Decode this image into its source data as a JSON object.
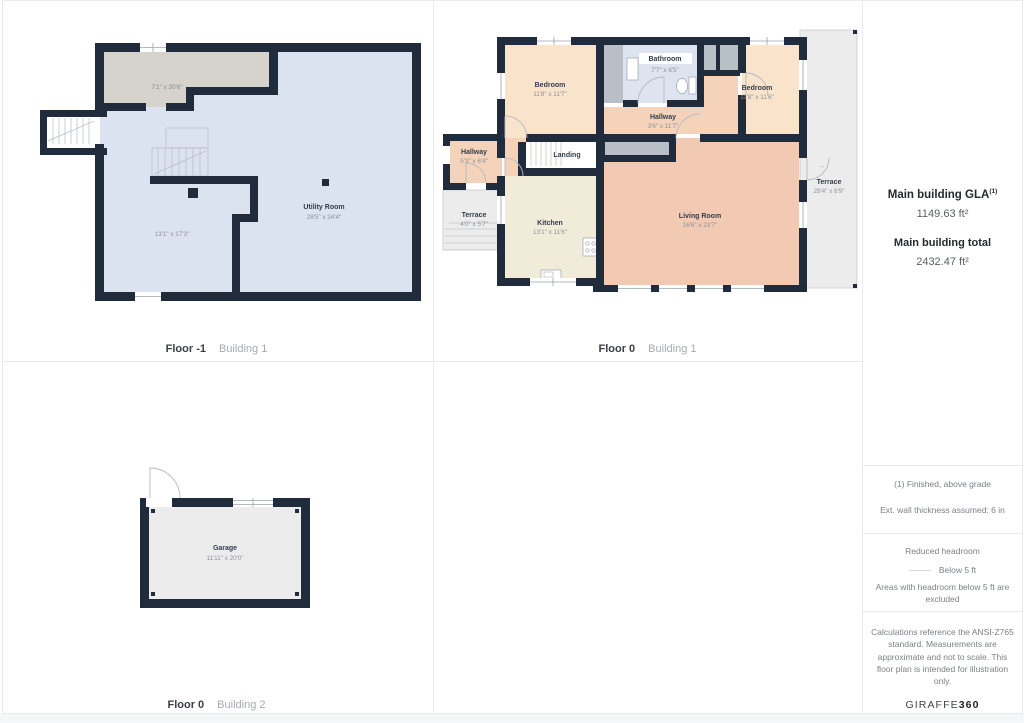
{
  "panels": {
    "b1fm1": {
      "floor": "Floor -1",
      "building": "Building 1",
      "reduced_dims": "7'1\" x 20'6\"",
      "room13_dims": "13'1\" x 17'3\"",
      "utility_name": "Utility Room",
      "utility_dims": "28'5\" x 34'4\""
    },
    "b1f0": {
      "floor": "Floor 0",
      "building": "Building 1",
      "bedroom_left": {
        "name": "Bedroom",
        "dims": "11'8\" x 11'7\""
      },
      "bathroom": {
        "name": "Bathroom",
        "dims": "7'7\" x 6'5\""
      },
      "bedroom_right": {
        "name": "Bedroom",
        "dims": "11'8\" x 11'6\""
      },
      "hallway_center": {
        "name": "Hallway",
        "dims": "3'6\" x 11'7\""
      },
      "hallway_left": {
        "name": "Hallway",
        "dims": "5'3\" x 6'4\""
      },
      "landing": {
        "name": "Landing"
      },
      "terrace_small": {
        "name": "Terrace",
        "dims": "4'0\" x 5'7\""
      },
      "kitchen": {
        "name": "Kitchen",
        "dims": "13'1\" x 11'6\""
      },
      "living": {
        "name": "Living Room",
        "dims": "16'6\" x 23'7\""
      },
      "terrace_right": {
        "name": "Terrace",
        "dims": "29'4\" x 6'9\""
      },
      "terrace_door_arrow": "→"
    },
    "b2f0": {
      "floor": "Floor 0",
      "building": "Building 2",
      "garage": {
        "name": "Garage",
        "dims": "11'11\" x 20'0\""
      }
    }
  },
  "sidebar": {
    "gla_title": "Main building GLA",
    "gla_sup": "(1)",
    "gla_value": "1149.63 ft²",
    "total_title": "Main building total",
    "total_value": "2432.47 ft²",
    "note_finished": "(1) Finished, above grade",
    "note_wall": "Ext. wall thickness assumed: 6 in",
    "headroom_title": "Reduced headroom",
    "headroom_legend": "Below 5 ft",
    "headroom_note": "Areas with headroom below 5 ft are excluded",
    "disclaimer": "Calculations reference the ANSI-Z765 standard. Measurements are approximate and not to scale. This floor plan is intended for illustration only.",
    "brand_left": "GIRAFFE",
    "brand_right": "360"
  },
  "colors": {
    "wall": "#202b3c",
    "basement_floor": "#dbe2f0",
    "reduced_headroom_gray": "#d6d3cd",
    "bedroom_peach": "#fae3cb",
    "hallway_peach": "#f4d3ba",
    "living_salmon": "#f2c9b2",
    "kitchen_cream": "#f1ecda",
    "bathroom_blue": "#dee4ef",
    "closet_gray": "#b9bfc7",
    "terrace_gray": "#ececec",
    "grid_line": "#e8eaec"
  }
}
